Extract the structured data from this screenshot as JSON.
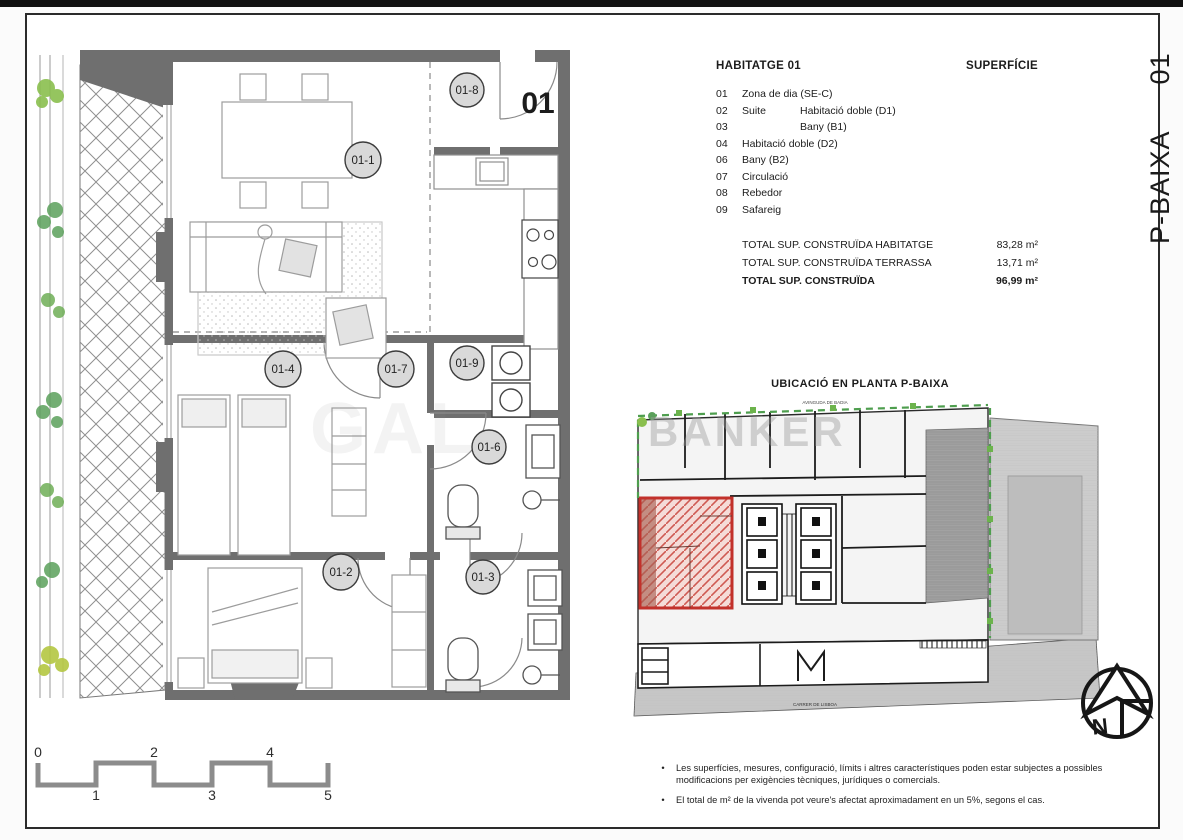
{
  "sheet": {
    "phase": "P-BAIXA",
    "unit": "01"
  },
  "legend": {
    "title": "HABITATGE 01",
    "col_header": "SUPERFÍCIE",
    "items": [
      {
        "num": "01",
        "col1": "Zona de dia (SE-C)",
        "col2": ""
      },
      {
        "num": "02",
        "col1": "Suite",
        "col2": "Habitació doble (D1)"
      },
      {
        "num": "03",
        "col1": "",
        "col2": "Bany (B1)"
      },
      {
        "num": "04",
        "col1": "Habitació doble (D2)",
        "col2": ""
      },
      {
        "num": "06",
        "col1": "Bany (B2)",
        "col2": ""
      },
      {
        "num": "07",
        "col1": "Circulació",
        "col2": ""
      },
      {
        "num": "08",
        "col1": "Rebedor",
        "col2": ""
      },
      {
        "num": "09",
        "col1": "Safareig",
        "col2": ""
      }
    ],
    "totals": [
      {
        "label": "TOTAL SUP. CONSTRUÏDA HABITATGE",
        "value": "83,28 m²"
      },
      {
        "label": "TOTAL SUP. CONSTRUÏDA TERRASSA",
        "value": "13,71 m²"
      },
      {
        "label": "TOTAL SUP. CONSTRUÏDA",
        "value": "96,99 m²"
      }
    ]
  },
  "plan": {
    "unit_number": "01",
    "rooms": [
      "01-1",
      "01-2",
      "01-3",
      "01-4",
      "01-6",
      "01-7",
      "01-8",
      "01-9"
    ]
  },
  "site": {
    "title": "UBICACIÓ EN PLANTA P-BAIXA",
    "street_top": "AVINGUDA DE BADIA",
    "street_bottom": "CARRER DE LISBOA"
  },
  "watermark": {
    "left_fragment": "GAL",
    "right_fragment": "BANKER"
  },
  "scalebar": {
    "labels_top": [
      "0",
      "2",
      "4"
    ],
    "labels_bottom": [
      "1",
      "3",
      "5"
    ]
  },
  "north": {
    "label": "N"
  },
  "notes": [
    "Les superfícies, mesures, configuració, límits i altres característiques poden estar subjectes a possibles modificacions per exigències tècniques, jurídiques o comercials.",
    "El total de m² de la vivenda pot veure's afectat aproximadament en un 5%, segons el cas."
  ]
}
